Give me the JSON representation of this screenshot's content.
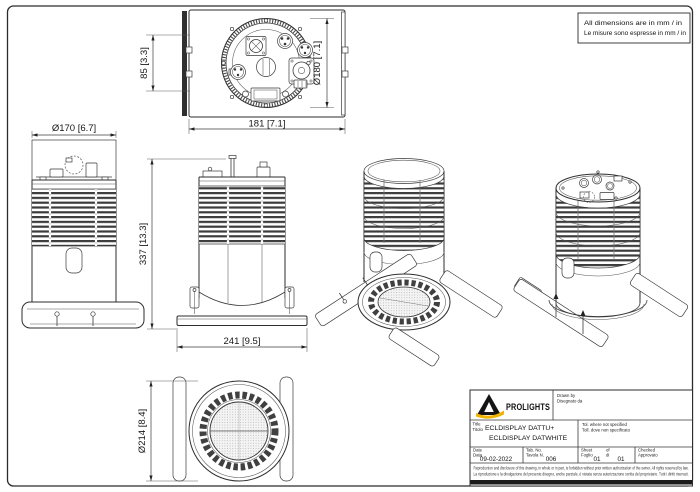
{
  "note_box": {
    "line1": "All dimensions are in mm / in",
    "line2": "Le misure sono espresse in mm / in"
  },
  "views": {
    "top": {
      "dim_height": "85 [3.3]",
      "dim_diameter": "Ø180 [7.1]",
      "dim_width": "181 [7.1]"
    },
    "side": {
      "dim_diameter": "Ø170 [6.7]",
      "dim_height": "337 [13.3]"
    },
    "front": {
      "dim_width": "241 [9.5]"
    },
    "bottom": {
      "dim_diameter": "Ø214 [8.4]"
    }
  },
  "title_block": {
    "brand": "PROLIGHTS",
    "drawn_label_en": "Drawn by",
    "drawn_label_it": "Disegnato da",
    "title_label_en": "Title",
    "title_label_it": "Titolo",
    "product_line1": "ECLDISPLAY DATTU+",
    "product_line2": "ECLDISPLAY DATWHITE",
    "tolerance_label_en": "Tol. where not specified",
    "tolerance_label_it": "Toll. dove non specificato",
    "date_label_en": "Date",
    "date_label_it": "Data",
    "date_value": "09-02-2022",
    "tab_label_en": "Tab. No.",
    "tab_label_it": "Tavola N.",
    "tab_value": "006",
    "sheet_label_en": "Sheet",
    "sheet_label_it": "Foglio",
    "sheet_value": "01",
    "of_label_en": "of",
    "of_label_it": "di",
    "of_value": "01",
    "checked_label_en": "Checked",
    "checked_label_it": "Approvato",
    "disclaimer_line1": "Reproduction and disclosure of this drawing, in whole or in part, is forbidden without prior written authorization of the owner. All rights reserved by law.",
    "disclaimer_line2": "La riproduzione e la divulgazione del presente disegno, anche parziale, è vietata senza autorizzazione scritta del proprietario. Tutti i diritti riservati."
  },
  "colors": {
    "line": "#2e2e2e",
    "accent_yellow": "#f0b400",
    "background": "#ffffff"
  }
}
